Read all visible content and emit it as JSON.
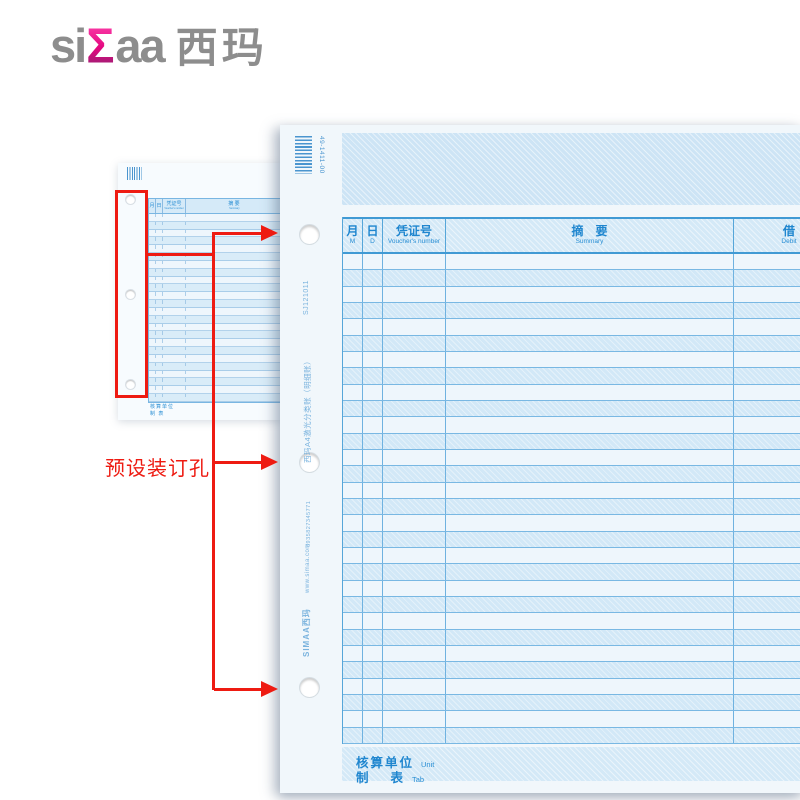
{
  "logo": {
    "part1": "si",
    "sigma": "Σ",
    "part2": "aa",
    "cn": "西玛"
  },
  "annotation": {
    "label": "预设装订孔",
    "color": "#ee1b12"
  },
  "small_form": {
    "stub_note": "西玛A4激光分类账",
    "header": {
      "month_cn": "月",
      "month_en": "M",
      "day_cn": "日",
      "day_en": "D",
      "voucher_cn": "凭证号",
      "voucher_en": "Voucher's number",
      "summary_cn": "摘 要",
      "summary_en": "Summary"
    },
    "row_count": 24,
    "footer": {
      "unit": "核算单位",
      "tab": "制  表"
    }
  },
  "big_form": {
    "barcode_label": "49-1411-00",
    "stub": {
      "code": "SJ121011",
      "product_title": "西玛A4激光分类账（明细账）",
      "ean": "6935827345771",
      "website": "www.simaa.com",
      "brand": "SIMAA西玛"
    },
    "table": {
      "row_count": 30,
      "columns": [
        {
          "cn": "月",
          "en": "M"
        },
        {
          "cn": "日",
          "en": "D"
        },
        {
          "cn": "凭证号",
          "en": "Voucher's number"
        },
        {
          "cn": "摘　要",
          "en": "Summary"
        },
        {
          "cn": "借",
          "en": "Debit"
        }
      ]
    },
    "footer": {
      "unit_cn": "核算单位",
      "unit_en": "Unit",
      "tab_cn": "制　 表",
      "tab_en": "Tab"
    }
  },
  "colors": {
    "accent_blue": "#1f86cf",
    "paper_blue": "#e9f3fa",
    "row_alt_blue": "#d2e8f7",
    "grid_blue": "#56a6d9",
    "annotation_red": "#ee1b12",
    "logo_gray": "#8d8d8d",
    "logo_magenta": "#e4077f"
  }
}
